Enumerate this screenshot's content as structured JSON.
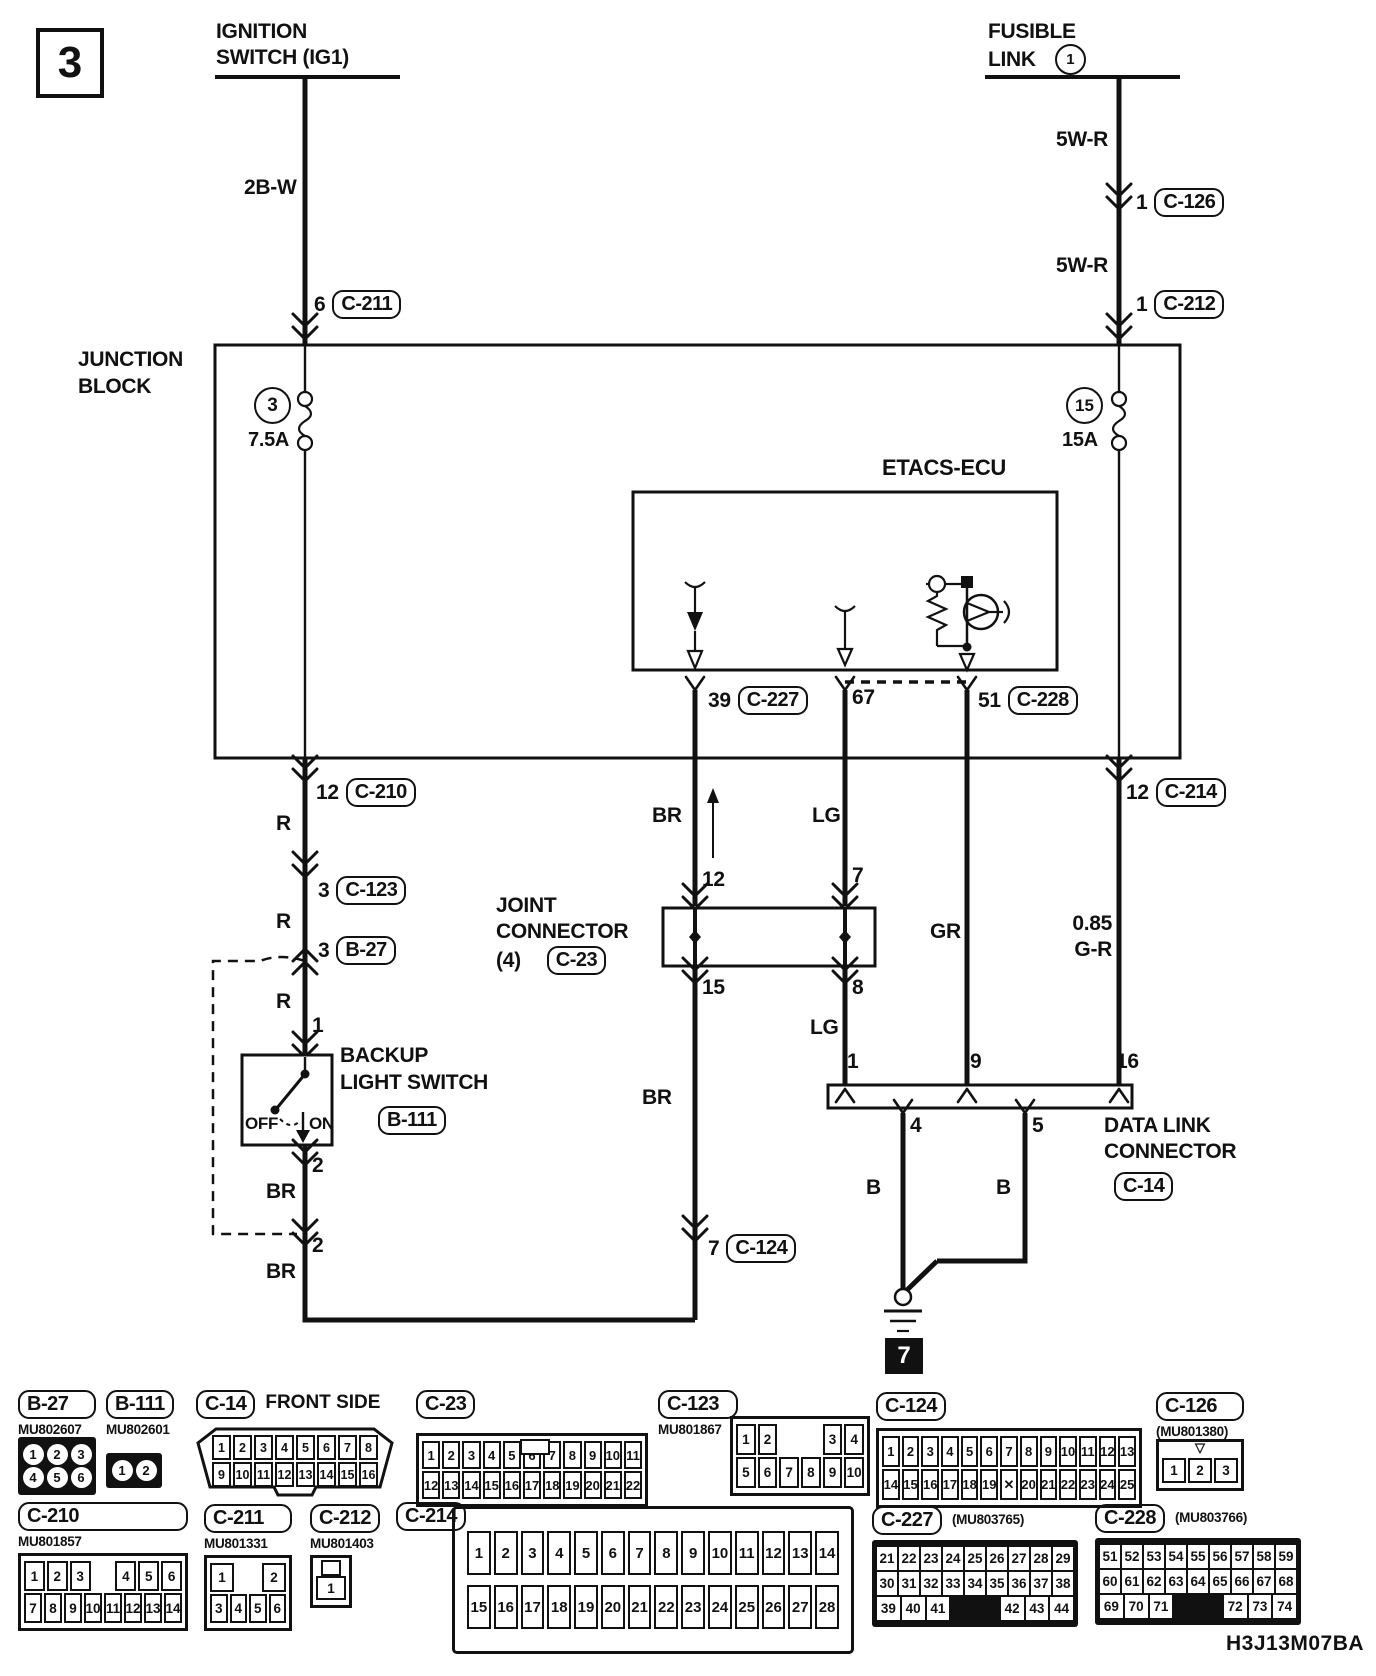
{
  "page": {
    "number": "3",
    "code": "H3J13M07BA"
  },
  "top": {
    "ignition": {
      "line1": "IGNITION",
      "line2": "SWITCH (IG1)"
    },
    "fusible": {
      "line1": "FUSIBLE",
      "line2": "LINK",
      "number": "1"
    },
    "wire_2bw": "2B-W",
    "wire_5wr_upper": "5W-R",
    "wire_5wr_lower": "5W-R",
    "c126": {
      "pin": "1",
      "ref": "C-126"
    },
    "c211": {
      "pin": "6",
      "ref": "C-211"
    },
    "c212": {
      "pin": "1",
      "ref": "C-212"
    }
  },
  "jb": {
    "line1": "JUNCTION",
    "line2": "BLOCK",
    "fuse_left": {
      "number": "3",
      "rating": "7.5A"
    },
    "fuse_right": {
      "number": "15",
      "rating": "15A"
    }
  },
  "etacs": {
    "label": "ETACS-ECU",
    "c227": {
      "pin": "39",
      "ref": "C-227"
    },
    "pin67": "67",
    "c228": {
      "pin": "51",
      "ref": "C-228"
    }
  },
  "mid": {
    "c210": {
      "pin": "12",
      "ref": "C-210"
    },
    "c123": {
      "pin": "3",
      "ref": "C-123"
    },
    "b27": {
      "pin": "3",
      "ref": "B-27"
    },
    "c214": {
      "pin": "12",
      "ref": "C-214"
    },
    "c124": {
      "pin": "7",
      "ref": "C-124"
    }
  },
  "wires": {
    "r1": "R",
    "r2": "R",
    "r3": "R",
    "br1": "BR",
    "br_mid": "BR",
    "br2": "BR",
    "br3": "BR",
    "lg1": "LG",
    "lg2": "LG",
    "gr": "GR",
    "gr_gauge": "0.85",
    "gr_color": "G-R",
    "b1": "B",
    "b2": "B"
  },
  "jc": {
    "line1": "JOINT",
    "line2": "CONNECTOR",
    "line3": "(4)",
    "ref": "C-23",
    "pin_in_left": "12",
    "pin_in_right": "7",
    "pin_out_left": "15",
    "pin_out_right": "8"
  },
  "sw": {
    "line1": "BACKUP",
    "line2": "LIGHT SWITCH",
    "ref": "B-111",
    "off": "OFF",
    "on": "ON",
    "pin1": "1",
    "pin2": "2",
    "pin2b": "2"
  },
  "dlc": {
    "line1": "DATA LINK",
    "line2": "CONNECTOR",
    "ref": "C-14",
    "p1": "1",
    "p9": "9",
    "p16": "16",
    "p4": "4",
    "p5": "5"
  },
  "ground": {
    "number": "7"
  },
  "connectors": [
    {
      "id": "b27",
      "label": "B-27",
      "part": "MU802607",
      "rows": [
        [
          "1",
          "2",
          "3"
        ],
        [
          "4",
          "5",
          "6"
        ]
      ]
    },
    {
      "id": "b111",
      "label": "B-111",
      "part": "MU802601",
      "rows": [
        [
          "1",
          "2"
        ]
      ]
    },
    {
      "id": "c14",
      "label": "C-14",
      "note": "FRONT SIDE",
      "rows": [
        [
          "1",
          "2",
          "3",
          "4",
          "5",
          "6",
          "7",
          "8"
        ],
        [
          "9",
          "10",
          "11",
          "12",
          "13",
          "14",
          "15",
          "16"
        ]
      ]
    },
    {
      "id": "c23",
      "label": "C-23",
      "rows": [
        [
          "1",
          "2",
          "3",
          "4",
          "5",
          "6",
          "7",
          "8",
          "9",
          "10",
          "11"
        ],
        [
          "12",
          "13",
          "14",
          "15",
          "16",
          "17",
          "18",
          "19",
          "20",
          "21",
          "22"
        ]
      ]
    },
    {
      "id": "c123",
      "label": "C-123",
      "part": "MU801867",
      "rows": [
        [
          "1",
          "2",
          "",
          "",
          "3",
          "4"
        ],
        [
          "5",
          "6",
          "7",
          "8",
          "9",
          "10"
        ]
      ]
    },
    {
      "id": "c124",
      "label": "C-124",
      "rows": [
        [
          "1",
          "2",
          "3",
          "4",
          "5",
          "6",
          "7",
          "8",
          "9",
          "10",
          "11",
          "12",
          "13"
        ],
        [
          "14",
          "15",
          "16",
          "17",
          "18",
          "19",
          "X",
          "20",
          "21",
          "22",
          "23",
          "24",
          "25"
        ]
      ]
    },
    {
      "id": "c126",
      "label": "C-126",
      "part": "(MU801380)",
      "rows": [
        [
          "1",
          "2",
          "3"
        ]
      ]
    },
    {
      "id": "c210",
      "label": "C-210",
      "part": "MU801857",
      "rows": [
        [
          "1",
          "2",
          "3",
          "",
          "4",
          "5",
          "6"
        ],
        [
          "7",
          "8",
          "9",
          "10",
          "11",
          "12",
          "13",
          "14"
        ]
      ]
    },
    {
      "id": "c211",
      "label": "C-211",
      "part": "MU801331",
      "rows": [
        [
          "1",
          "",
          "2"
        ],
        [
          "3",
          "4",
          "5",
          "6"
        ]
      ]
    },
    {
      "id": "c212",
      "label": "C-212",
      "part": "MU801403",
      "rows": [
        [
          "1"
        ]
      ]
    },
    {
      "id": "c214",
      "label": "C-214",
      "rows": [
        [
          "1",
          "2",
          "3",
          "4",
          "5",
          "6",
          "7",
          "8",
          "9",
          "10",
          "11",
          "12",
          "13",
          "14"
        ],
        [
          "15",
          "16",
          "17",
          "18",
          "19",
          "20",
          "21",
          "22",
          "23",
          "24",
          "25",
          "26",
          "27",
          "28"
        ]
      ]
    },
    {
      "id": "c227",
      "label": "C-227",
      "part": "(MU803765)",
      "rows": [
        [
          "21",
          "22",
          "23",
          "24",
          "25",
          "26",
          "27",
          "28",
          "29"
        ],
        [
          "30",
          "31",
          "32",
          "33",
          "34",
          "35",
          "36",
          "37",
          "38"
        ],
        [
          "39",
          "40",
          "41",
          "",
          "",
          "42",
          "43",
          "44"
        ]
      ]
    },
    {
      "id": "c228",
      "label": "C-228",
      "part": "(MU803766)",
      "rows": [
        [
          "51",
          "52",
          "53",
          "54",
          "55",
          "56",
          "57",
          "58",
          "59"
        ],
        [
          "60",
          "61",
          "62",
          "63",
          "64",
          "65",
          "66",
          "67",
          "68"
        ],
        [
          "69",
          "70",
          "71",
          "",
          "",
          "72",
          "73",
          "74"
        ]
      ]
    }
  ]
}
